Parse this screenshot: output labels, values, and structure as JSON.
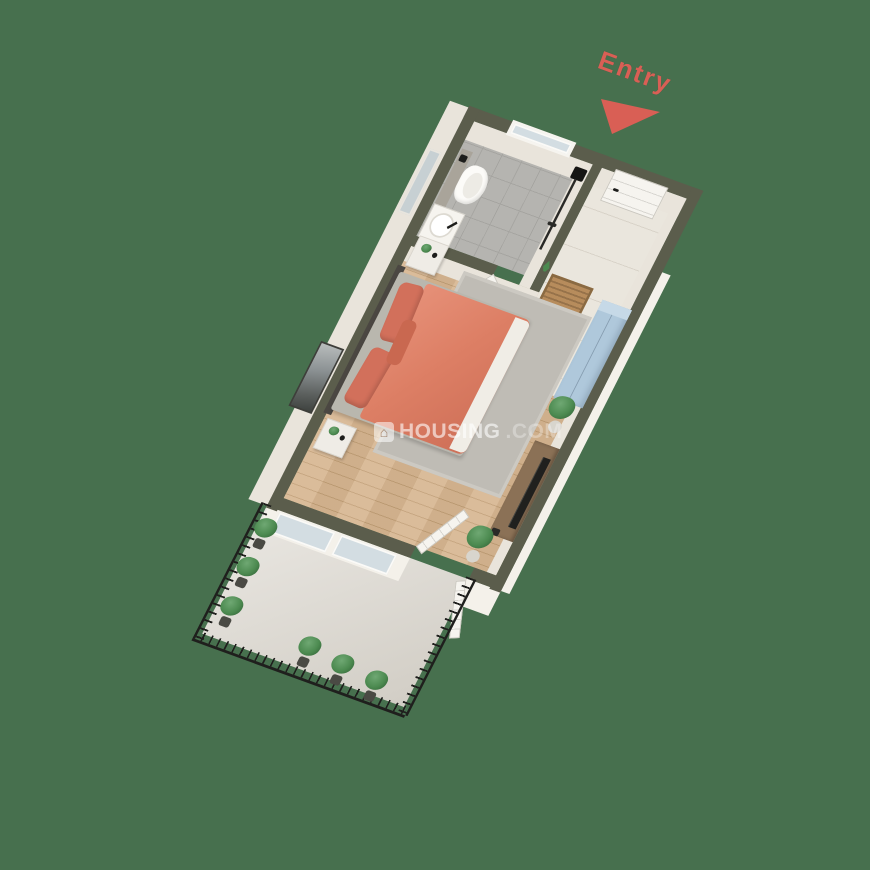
{
  "scene": {
    "description": "3D isometric floor plan render of a studio apartment with bedroom, bathroom, foyer and balcony",
    "background_color": "#47704E"
  },
  "entry_marker": {
    "label": "Entry",
    "color": "#D95F55",
    "arrow": "triangle-pointing-down-left"
  },
  "watermark": {
    "icon": "housing-logo-house-icon",
    "icon_glyph": "⌂",
    "text": "HOUSING",
    "suffix": ".COM"
  },
  "rooms": [
    {
      "name": "bathroom",
      "floor": "grey-marble-tile",
      "fixtures": [
        "window",
        "shower-set",
        "wall-hung-toilet",
        "concrete-cistern-panel",
        "round-washbasin",
        "mirror",
        "bathroom-door"
      ]
    },
    {
      "name": "foyer",
      "floor": "cream-marble",
      "fixtures": [
        "entry-door",
        "doormat",
        "blue-wardrobe",
        "wall-plant-decal"
      ]
    },
    {
      "name": "bedroom",
      "floor": "wooden-planks",
      "fixtures": [
        "double-bed",
        "coral-duvet",
        "pillows",
        "headboard",
        "nightstand-north",
        "nightstand-south",
        "area-rug",
        "wall-art",
        "tv-console",
        "television",
        "floor-plant-north",
        "floor-plant-south"
      ]
    },
    {
      "name": "balcony",
      "floor": "light-stone",
      "fixtures": [
        "iron-railing",
        "french-door",
        "potted-plants-left-row",
        "potted-plants-front-row"
      ]
    }
  ],
  "colors": {
    "background": "#47704E",
    "wall_top": "#5B5D4C",
    "wall_face": "#E9E4DB",
    "wall_bright": "#F4F1EA",
    "wood_floor": "#D7B691",
    "wood_line": "#C2A077",
    "bath_tile": "#B5B4B0",
    "bath_tile_line": "#A5A4A0",
    "marble_floor": "#EAE6DD",
    "balcony_floor": "#DEDAD2",
    "rug": "#BFBCB5",
    "duvet": "#DD7F65",
    "pillow": "#D2705B",
    "headboard": "#4B4742",
    "mattress": "#B9B7AE",
    "wardrobe": "#AFC8DB",
    "wardrobe_top": "#C6D9E7",
    "console_wood": "#8B7156",
    "tv_black": "#20201E",
    "doormat": "#B78C5C",
    "doormat_border": "#8A6A42",
    "railing": "#1F1F1D",
    "plant_green": "#4C8A50",
    "plant_dark": "#2F5D34",
    "pot_light": "#D8D5CD",
    "pot_dark": "#4A4A44",
    "door_white": "#F6F4EF",
    "glass": "#D3DDE2",
    "mirror": "#C7D0D3",
    "cistern": "#A9A49A",
    "entry_red": "#D95F55"
  }
}
